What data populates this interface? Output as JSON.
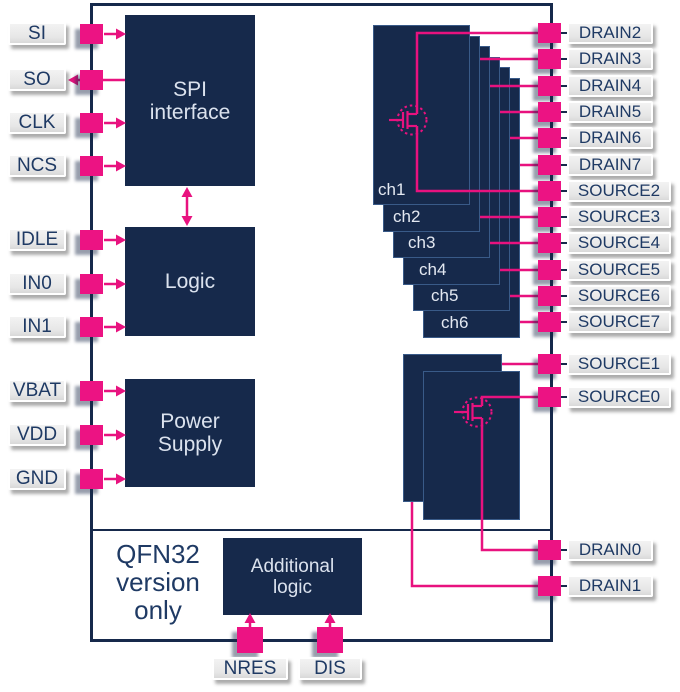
{
  "colors": {
    "navy": "#16294b",
    "magenta": "#ec1383",
    "wire": "#e8127f",
    "label_text": "#1f3a64",
    "block_text": "#dbe2ee",
    "label_bg": "#e6e6e6"
  },
  "left_pins": [
    "SI",
    "SO",
    "CLK",
    "NCS",
    "IDLE",
    "IN0",
    "IN1",
    "VBAT",
    "VDD",
    "GND"
  ],
  "right_pins": [
    "DRAIN2",
    "DRAIN3",
    "DRAIN4",
    "DRAIN5",
    "DRAIN6",
    "DRAIN7",
    "SOURCE2",
    "SOURCE3",
    "SOURCE4",
    "SOURCE5",
    "SOURCE6",
    "SOURCE7"
  ],
  "right_pins_lower": [
    "SOURCE1",
    "SOURCE0"
  ],
  "right_pins_bottom": [
    "DRAIN0",
    "DRAIN1"
  ],
  "bottom_pins": [
    "NRES",
    "DIS"
  ],
  "blocks": {
    "spi": {
      "line1": "SPI",
      "line2": "interface"
    },
    "logic": {
      "label": "Logic"
    },
    "power": {
      "line1": "Power",
      "line2": "Supply"
    },
    "additional": {
      "line1": "Additional",
      "line2": "logic"
    }
  },
  "channels": [
    "ch1",
    "ch2",
    "ch3",
    "ch4",
    "ch5",
    "ch6"
  ],
  "note": {
    "line1": "QFN32",
    "line2": "version",
    "line3": "only"
  }
}
